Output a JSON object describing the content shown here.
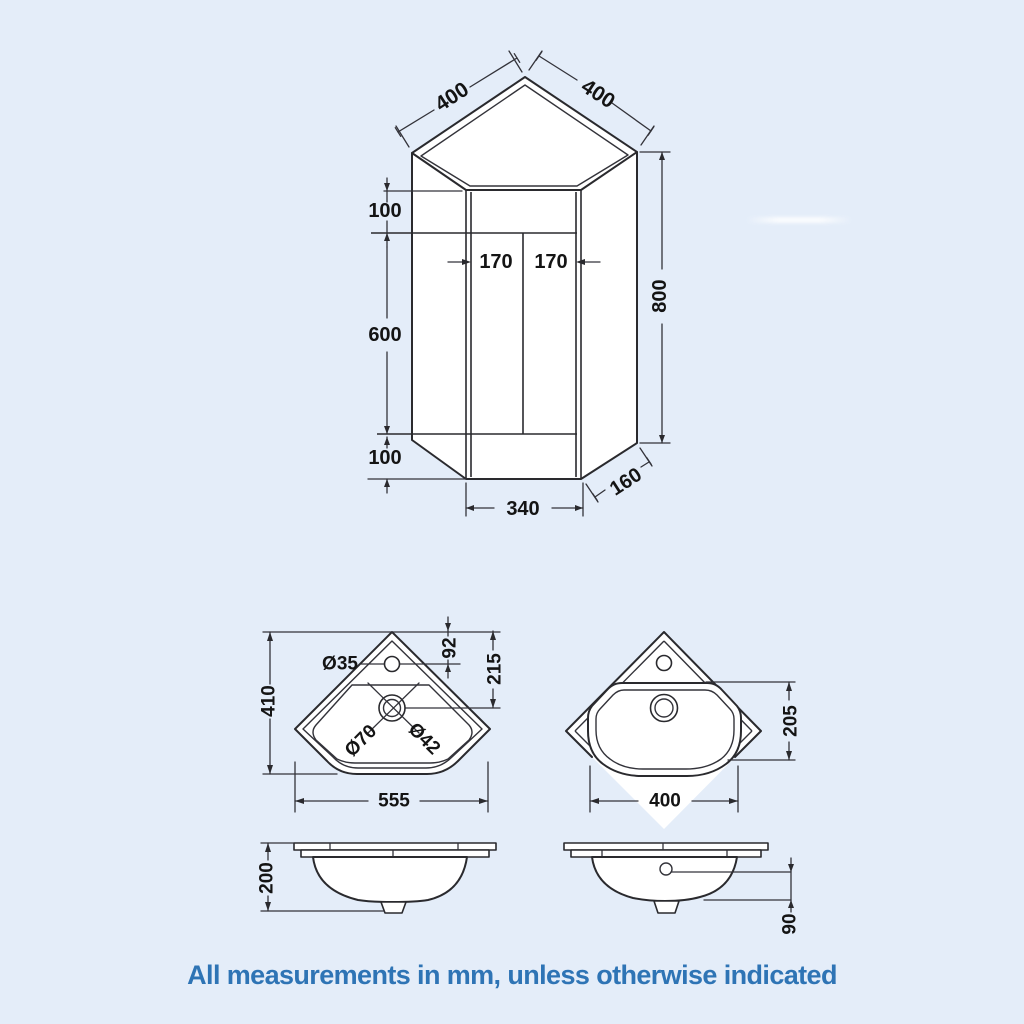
{
  "page": {
    "footer_note": "All measurements in mm, unless otherwise indicated",
    "background_color": "#e4edf9",
    "footer_text_color": "#2e74b5",
    "line_color": "#2a2a2e",
    "dim_text_color": "#141414"
  },
  "cabinet": {
    "dims": {
      "top_left_edge": "400",
      "top_right_edge": "400",
      "counter_band": "100",
      "door_height": "600",
      "plinth_height": "100",
      "overall_height": "800",
      "left_door_width": "170",
      "right_door_width": "170",
      "front_width": "340",
      "side_return": "160"
    }
  },
  "basin_plan": {
    "dims": {
      "tap_hole": "Ø35",
      "tap_setback": "92",
      "waste_setback": "215",
      "depth": "410",
      "waste_outer": "Ø70",
      "waste_inner": "Ø42",
      "width": "555"
    }
  },
  "basin_front": {
    "dims": {
      "bowl_depth": "205",
      "bowl_width": "400"
    }
  },
  "basin_side_left": {
    "dims": {
      "height": "200"
    }
  },
  "basin_side_right": {
    "dims": {
      "overflow_setback": "90"
    }
  }
}
